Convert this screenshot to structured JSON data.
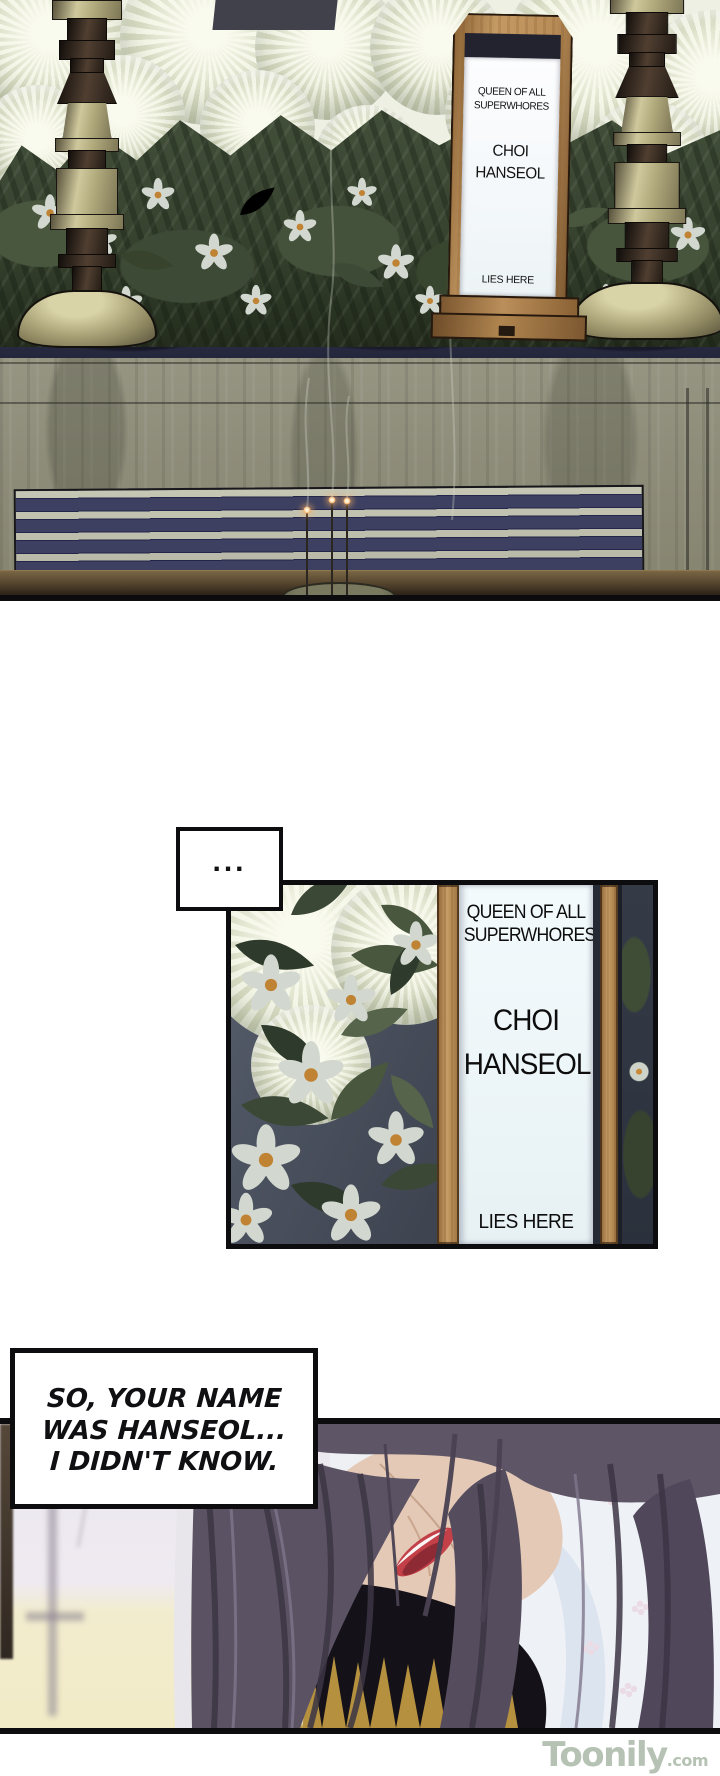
{
  "memorial_tablet": {
    "epithet_line1": "QUEEN OF ALL",
    "epithet_line2": "SUPERWHORES",
    "name_line1": "CHOI",
    "name_line2": "HANSEOL",
    "footer": "LIES HERE"
  },
  "dialogue": {
    "ellipsis": "...",
    "narration_line1": "SO, YOUR NAME",
    "narration_line2": "WAS HANSEOL...",
    "narration_line3": "I DIDN'T KNOW."
  },
  "watermark": {
    "brand": "Toonily",
    "tld": ".com"
  },
  "colors": {
    "panel_border": "#0d0d0f",
    "tablet_wood": "#b98f5d",
    "tablet_paper": "#eef6f8",
    "stripe_navy": "#3d4060",
    "altar_navy": "#2c2e46",
    "brass": "#bdb68a",
    "foliage_green": "#3c4a34",
    "hair_gray_purple": "#5b5364",
    "lips_red": "#c34049",
    "gold_hair": "#b5913f",
    "watermark_green": "#b6c2b3"
  }
}
